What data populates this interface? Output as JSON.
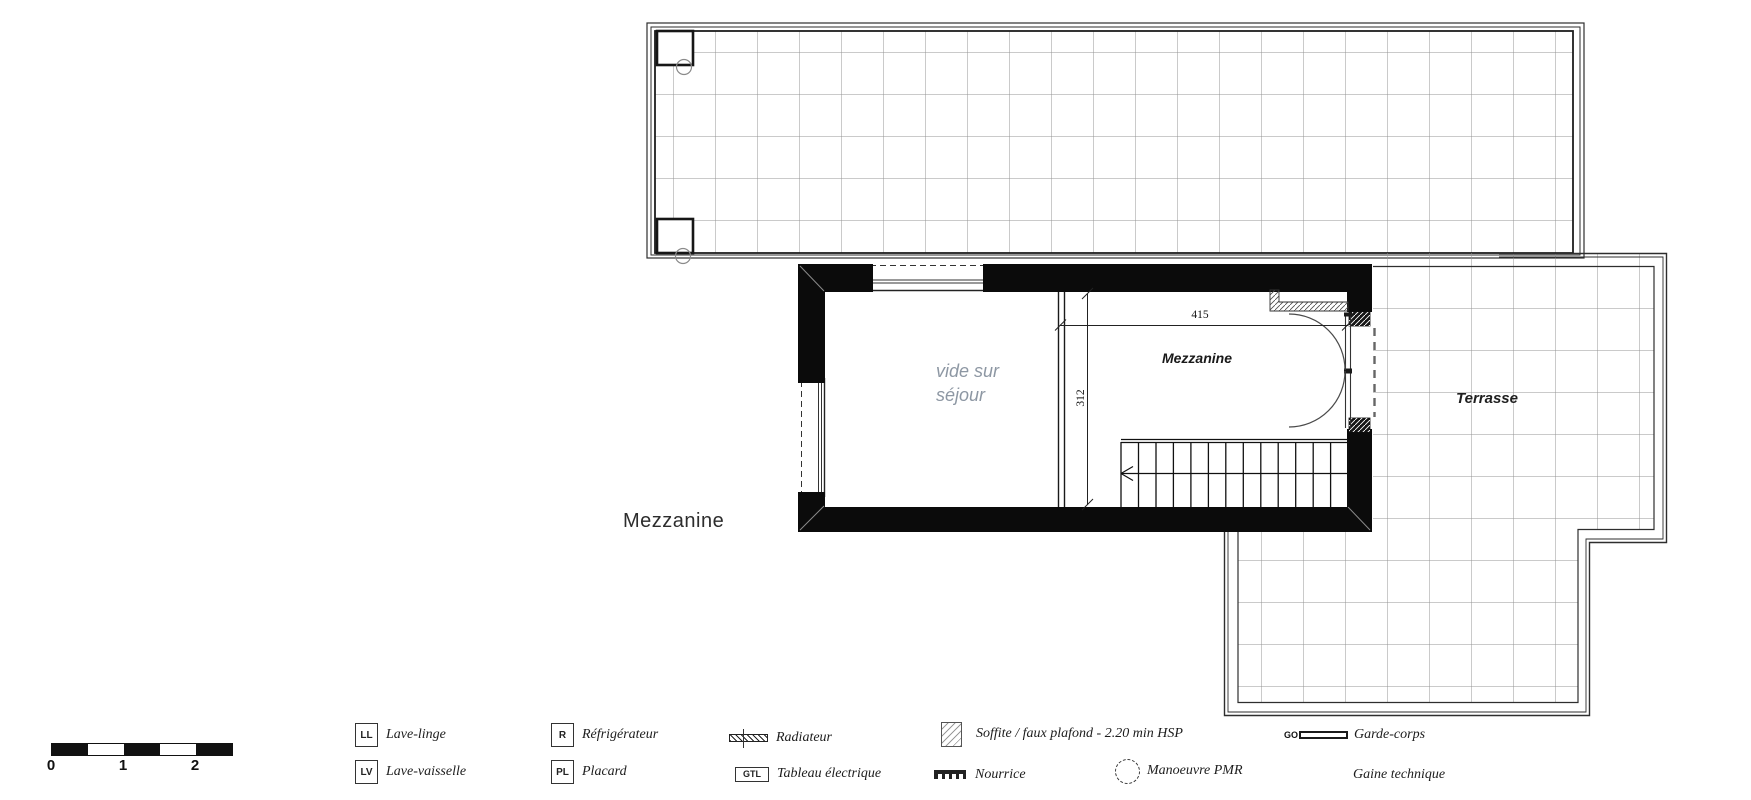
{
  "plan": {
    "floor_label": "Mezzanine",
    "room_label": "Mezzanine",
    "void_label_line1": "vide sur",
    "void_label_line2": "séjour",
    "terrace_label": "Terrasse",
    "dim_width": "415",
    "dim_height": "312"
  },
  "scale_bar": {
    "labels": [
      "0",
      "1",
      "2"
    ]
  },
  "legend": {
    "items": [
      {
        "id": "lave-linge",
        "symbol": "LL",
        "label": "Lave-linge"
      },
      {
        "id": "lave-vaisselle",
        "symbol": "LV",
        "label": "Lave-vaisselle"
      },
      {
        "id": "refrigerateur",
        "symbol": "R",
        "label": "Réfrigérateur"
      },
      {
        "id": "placard",
        "symbol": "PL",
        "label": "Placard"
      },
      {
        "id": "radiateur",
        "symbol": "hatched-bar",
        "label": "Radiateur"
      },
      {
        "id": "tableau-electrique",
        "symbol": "GTL",
        "label": "Tableau électrique"
      },
      {
        "id": "soffite",
        "symbol": "hatched-square",
        "label": "Soffite / faux plafond - 2.20 min HSP"
      },
      {
        "id": "nourrice",
        "symbol": "manifold",
        "label": "Nourrice"
      },
      {
        "id": "garde-corps",
        "symbol": "GO",
        "label": "Garde-corps"
      },
      {
        "id": "manoeuvre-pmr",
        "symbol": "dashed-circle",
        "label": "Manoeuvre PMR"
      },
      {
        "id": "gaine-technique",
        "symbol": "none",
        "label": "Gaine technique"
      }
    ]
  },
  "colors": {
    "wall": "#0b0b0b",
    "grid": "#949494",
    "outline": "#2e2e2e",
    "void_text": "#8d97a3",
    "text": "#1c1c1c"
  }
}
